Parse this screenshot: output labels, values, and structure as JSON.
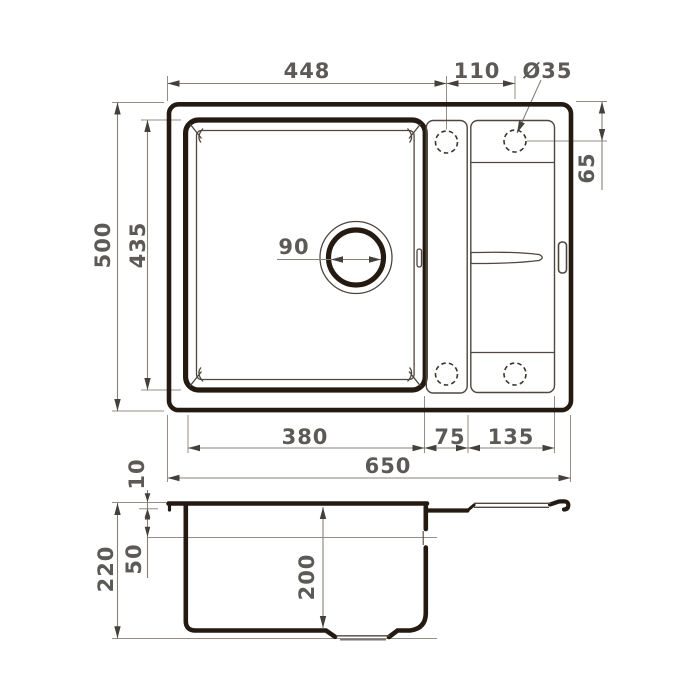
{
  "dims": {
    "d448": "448",
    "d110": "110",
    "d35": "Ø35",
    "d65": "65",
    "d500": "500",
    "d435": "435",
    "d90": "90",
    "d380": "380",
    "d75": "75",
    "d135": "135",
    "d650": "650",
    "d10": "10",
    "d50": "50",
    "d220": "220",
    "d200": "200"
  },
  "colors": {
    "thick_line": "#241a12",
    "thin_line": "#4f463e",
    "dashed_line": "#3c352d",
    "dimension_line": "#87817a",
    "extension_line": "#948e87",
    "arrow": "#44403a",
    "dim_text": "#5c5a57",
    "background": "#ffffff"
  }
}
